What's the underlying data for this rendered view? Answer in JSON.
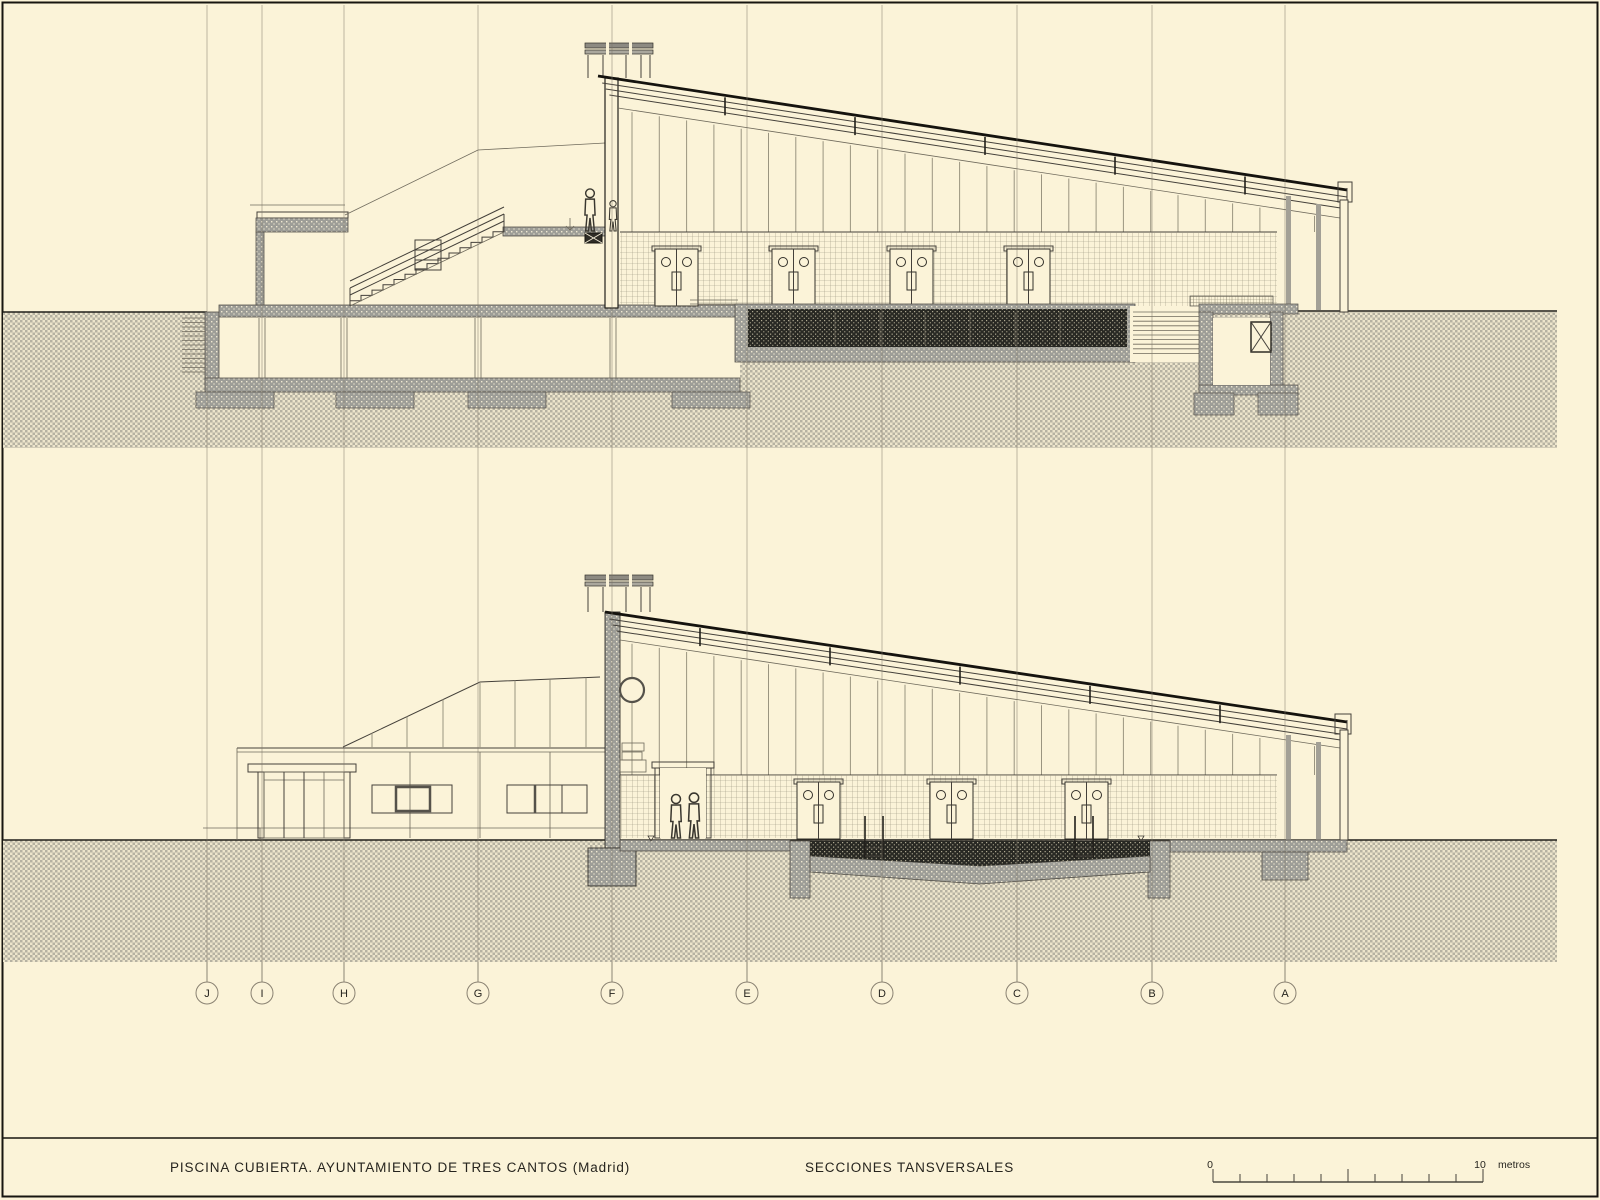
{
  "page": {
    "background_color": "#FBF3D8",
    "frame_color": "#17150f"
  },
  "title_block": {
    "project_title": "PISCINA CUBIERTA. AYUNTAMIENTO DE TRES CANTOS (Madrid)",
    "sheet_title": "SECCIONES TANSVERSALES"
  },
  "grid": {
    "labels": [
      "J",
      "I",
      "H",
      "G",
      "F",
      "E",
      "D",
      "C",
      "B",
      "A"
    ]
  },
  "scale_bar": {
    "zero_label": "0",
    "ten_label": "10",
    "unit_label": "metros",
    "total_meters": 10,
    "divisions": 10
  },
  "colors": {
    "ground_hatch": "#B6B2A2",
    "wall_fill": "#9D9D97",
    "water_fill": "#282823",
    "line_dark": "#2B2923",
    "line_light": "#8D8575"
  }
}
